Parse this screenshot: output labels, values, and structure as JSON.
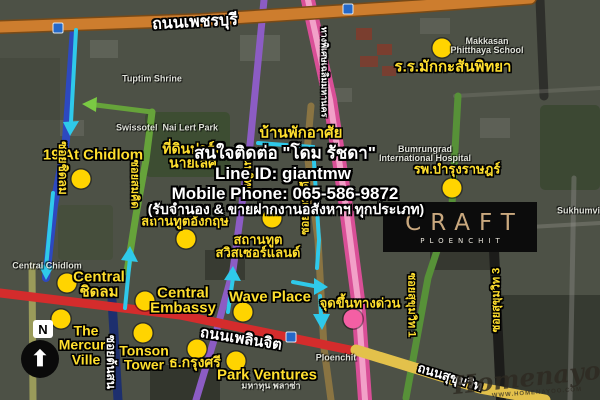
{
  "page_title": "CRAFT Ploenchit location map",
  "logo": {
    "brand": "CRAFT",
    "sub": "PLOENCHIT"
  },
  "contact": {
    "line1": "สนใจติดต่อ \"โดม รัชดา\"",
    "line2": "Line ID: giantmw",
    "line3": "Mobile Phone: 065-586-9872",
    "line4": "(รับจำนอง & ขายฝากงานอสังหาฯ ทุกประเภท)"
  },
  "compass": {
    "label": "N",
    "arrow": "⬆"
  },
  "watermark": {
    "name": "Homenayoo",
    "url": "WWW.HOMENAYOO.COM"
  },
  "colors": {
    "poi_yellow": "#ffdf2e",
    "marker_yellow": "#ffd400",
    "marker_pink": "#f45fa4",
    "route_cyan": "#2fc9ea",
    "route_green": "#7ac943",
    "road_orange": "#cd7d2e",
    "road_red": "#d42c2c",
    "road_pink": "#d94f97",
    "road_purple": "#8c5cc4",
    "road_blue": "#2d49c0",
    "logo_gold": "#c9a87e"
  },
  "map": {
    "labels": [
      {
        "name": "makkasan-school-label",
        "text": "ร.ร.มักกะสันพิทยา",
        "x": 453,
        "y": 67,
        "fs": 15,
        "cls": "poi"
      },
      {
        "name": "nineteen-at-chidlom-label",
        "text": "19 At Chidlom",
        "x": 93,
        "y": 155,
        "fs": 15,
        "cls": "poi"
      },
      {
        "name": "nai-lert-park-land-label",
        "text": "ที่ดินปาร์ค\nนายเลิศ",
        "x": 193,
        "y": 156,
        "fs": 14,
        "cls": "poi"
      },
      {
        "name": "residence-label",
        "text": "บ้านพักอาศัย",
        "x": 301,
        "y": 133,
        "fs": 15,
        "cls": "poi"
      },
      {
        "name": "bumrungrad-hospital-label",
        "text": "รพ.บำรุงราษฎร์",
        "x": 457,
        "y": 169,
        "fs": 13,
        "cls": "poi"
      },
      {
        "name": "british-embassy-label",
        "text": "สถานทูตอังกฤษ",
        "x": 185,
        "y": 221,
        "fs": 13,
        "cls": "poi"
      },
      {
        "name": "swiss-embassy-label",
        "text": "สถานทูต\nสวิสเซอร์แลนด์",
        "x": 258,
        "y": 246,
        "fs": 13,
        "cls": "poi"
      },
      {
        "name": "central-chidlom-label",
        "text": "Central\nชิดลม",
        "x": 99,
        "y": 285,
        "fs": 15,
        "cls": "poi"
      },
      {
        "name": "central-embassy-label",
        "text": "Central\nEmbassy",
        "x": 183,
        "y": 301,
        "fs": 15,
        "cls": "poi"
      },
      {
        "name": "wave-place-label",
        "text": "Wave Place",
        "x": 270,
        "y": 297,
        "fs": 15,
        "cls": "poi"
      },
      {
        "name": "expressway-entrance-label",
        "text": "จุดขึ้นทางด่วน",
        "x": 360,
        "y": 303,
        "fs": 13,
        "cls": "poi"
      },
      {
        "name": "mercury-ville-label",
        "text": "The\nMercury\nVille",
        "x": 86,
        "y": 345,
        "fs": 14,
        "cls": "poi"
      },
      {
        "name": "tonson-tower-label",
        "text": "Tonson\nTower",
        "x": 144,
        "y": 358,
        "fs": 14,
        "cls": "poi"
      },
      {
        "name": "krungsri-bank-label",
        "text": "ธ.กรุงศรี",
        "x": 195,
        "y": 362,
        "fs": 14,
        "cls": "poi"
      },
      {
        "name": "park-ventures-label",
        "text": "Park Ventures",
        "x": 267,
        "y": 375,
        "fs": 15,
        "cls": "poi"
      },
      {
        "name": "phetchaburi-road-label",
        "text": "ถนนเพชรบุรี",
        "x": 195,
        "y": 23,
        "fs": 16,
        "cls": "road",
        "rot": -3
      },
      {
        "name": "ploenchit-road-label",
        "text": "ถนนเพลินจิต",
        "x": 241,
        "y": 339,
        "fs": 15,
        "cls": "road",
        "rot": 9
      },
      {
        "name": "sukhumvit-road-label",
        "text": "ถนนสุขุมวิท",
        "x": 450,
        "y": 377,
        "fs": 13,
        "cls": "road",
        "rot": 17
      },
      {
        "name": "soi-chidlom-label",
        "text": "ซอยชิดลม",
        "x": 63,
        "y": 168,
        "fs": 12,
        "cls": "poi",
        "rot": 90
      },
      {
        "name": "soi-somkid-label",
        "text": "ซอยสมคิด",
        "x": 134,
        "y": 184,
        "fs": 11,
        "cls": "poi",
        "rot": 90
      },
      {
        "name": "witthayu-road-label",
        "text": "(ถนนวิทยุ)",
        "x": 247,
        "y": 172,
        "fs": 11,
        "cls": "poi",
        "rot": 90
      },
      {
        "name": "soi-ruamrudi-label",
        "text": "ซอยร่วมฤดี",
        "x": 306,
        "y": 208,
        "fs": 11,
        "cls": "poi",
        "rot": -90
      },
      {
        "name": "soi-tonson-label",
        "text": "ซอยต้นสน",
        "x": 111,
        "y": 362,
        "fs": 12,
        "cls": "road",
        "rot": 90
      },
      {
        "name": "soi-sukhumvit-1-label",
        "text": "ซอยสุขุมวิท 1",
        "x": 411,
        "y": 305,
        "fs": 11,
        "cls": "poi",
        "rot": 90
      },
      {
        "name": "soi-sukhumvit-3-label",
        "text": "ซอยสุขุมวิท 3",
        "x": 497,
        "y": 300,
        "fs": 11,
        "cls": "poi",
        "rot": -90
      },
      {
        "name": "expressway-road-label",
        "text": "ทางพิเศษเฉลิมมหานคร",
        "x": 324,
        "y": 72,
        "fs": 9,
        "cls": "road",
        "rot": 90
      },
      {
        "name": "tuptim-shrine-map-label",
        "text": "Tuptim Shrine",
        "x": 152,
        "y": 79,
        "fs": 9,
        "cls": "base"
      },
      {
        "name": "makkasan-school-map-label",
        "text": "Makkasan\nPhitthaya School",
        "x": 487,
        "y": 46,
        "fs": 9,
        "cls": "base"
      },
      {
        "name": "swissotel-nai-lert-map-label",
        "text": "Swissotel  Nai Lert Park",
        "x": 167,
        "y": 128,
        "fs": 9,
        "cls": "base"
      },
      {
        "name": "bumrungrad-map-label",
        "text": "Bumrungrad\nInternational Hospital",
        "x": 425,
        "y": 154,
        "fs": 9,
        "cls": "base"
      },
      {
        "name": "central-chidlom-map-label",
        "text": "Central Chidlom",
        "x": 47,
        "y": 266,
        "fs": 9,
        "cls": "base"
      },
      {
        "name": "ploenchit-station-map-label",
        "text": "Ploenchit",
        "x": 336,
        "y": 358,
        "fs": 9,
        "cls": "base"
      },
      {
        "name": "sukhumvit-map-label",
        "text": "Sukhumvit",
        "x": 580,
        "y": 211,
        "fs": 9,
        "cls": "base"
      },
      {
        "name": "mahatun-plaza-map-label",
        "text": "มหาทุน พลาซ่า",
        "x": 271,
        "y": 386,
        "fs": 9,
        "cls": "base"
      }
    ],
    "markers": [
      {
        "name": "marker-makkasan-school",
        "x": 442,
        "y": 48,
        "color": "#ffd400"
      },
      {
        "name": "marker-19-at-chidlom",
        "x": 81,
        "y": 179,
        "color": "#ffd400"
      },
      {
        "name": "marker-bumrungrad",
        "x": 452,
        "y": 188,
        "color": "#ffd400"
      },
      {
        "name": "marker-swiss-embassy",
        "x": 272,
        "y": 218,
        "color": "#ffd400"
      },
      {
        "name": "marker-british-embassy",
        "x": 186,
        "y": 239,
        "color": "#ffd400"
      },
      {
        "name": "marker-central-chidlom",
        "x": 67,
        "y": 283,
        "color": "#ffd400"
      },
      {
        "name": "marker-central-embassy",
        "x": 145,
        "y": 301,
        "color": "#ffd400"
      },
      {
        "name": "marker-wave-place",
        "x": 243,
        "y": 312,
        "color": "#ffd400"
      },
      {
        "name": "marker-mercury-ville",
        "x": 61,
        "y": 319,
        "color": "#ffd400"
      },
      {
        "name": "marker-tonson-tower",
        "x": 143,
        "y": 333,
        "color": "#ffd400"
      },
      {
        "name": "marker-krungsri-bank",
        "x": 197,
        "y": 349,
        "color": "#ffd400"
      },
      {
        "name": "marker-park-ventures",
        "x": 236,
        "y": 361,
        "color": "#ffd400"
      },
      {
        "name": "marker-expressway-entrance",
        "x": 353,
        "y": 319,
        "color": "#f45fa4"
      }
    ],
    "station_icons": [
      {
        "name": "bts-station-icon",
        "x": 58,
        "y": 28
      },
      {
        "name": "bts-station-icon",
        "x": 348,
        "y": 9
      },
      {
        "name": "bts-station-icon",
        "x": 291,
        "y": 337
      }
    ]
  }
}
